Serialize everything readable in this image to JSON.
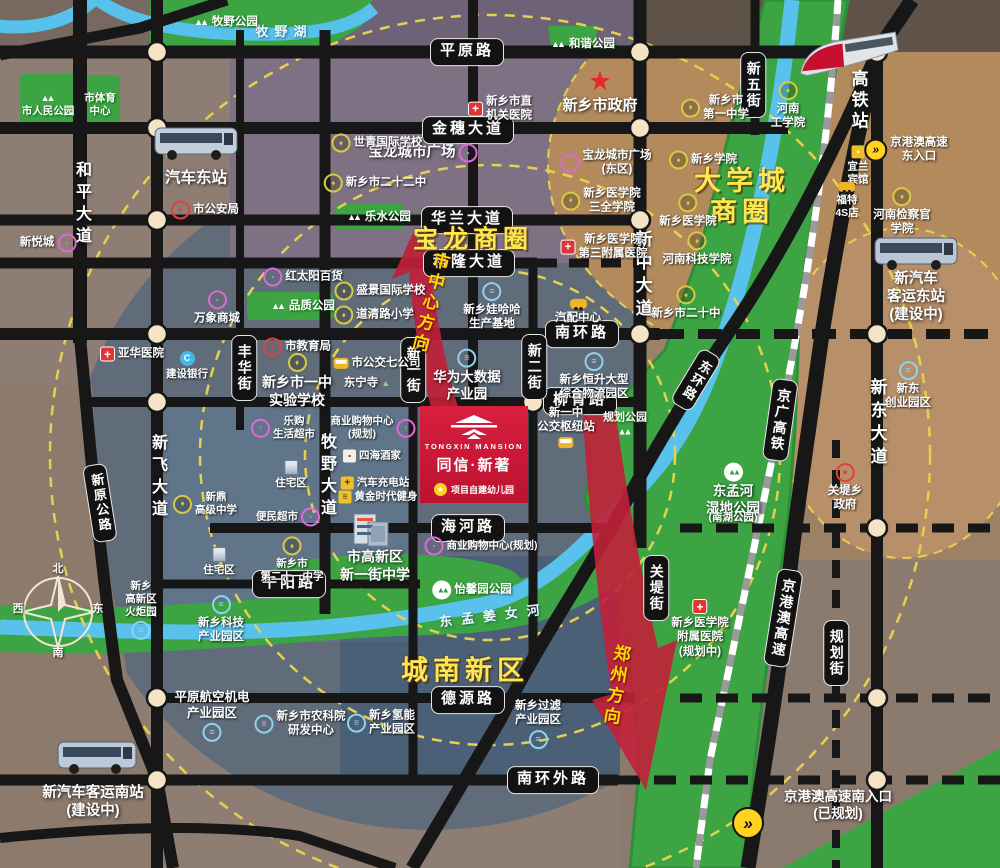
{
  "project": {
    "name_en": "TONGXIN MANSION",
    "name_cn": "同信·新著",
    "note": "项目自建幼儿园"
  },
  "colors": {
    "accent_red": "#c81734",
    "area_yellow": "#ffe54f",
    "green": "#3ca443",
    "river_blue": "#58c2ec",
    "road_black": "#171717",
    "dot_cream": "#f4e4c5",
    "dash_yellow": "#e6d14f"
  },
  "labels": [
    {
      "id": "road-pingyuanlu",
      "t": "平原路",
      "x": 467,
      "y": 52,
      "c": "pillh"
    },
    {
      "id": "road-jinsui-ave",
      "t": "金穗大道",
      "x": 468,
      "y": 130,
      "c": "pillh"
    },
    {
      "id": "road-hualan-ave",
      "t": "华兰大道",
      "x": 467,
      "y": 220,
      "c": "pillh"
    },
    {
      "id": "road-kelong-ave",
      "t": "科隆大道",
      "x": 469,
      "y": 263,
      "c": "pillh"
    },
    {
      "id": "road-nanhuanlu",
      "t": "南环路",
      "x": 582,
      "y": 334,
      "c": "pillh"
    },
    {
      "id": "road-liuqinglu",
      "t": "柳青路",
      "x": 580,
      "y": 401,
      "c": "pillh"
    },
    {
      "id": "road-haihelu",
      "t": "海河路",
      "x": 468,
      "y": 528,
      "c": "pillh"
    },
    {
      "id": "road-wuyanglu",
      "t": "午阳路",
      "x": 289,
      "y": 584,
      "c": "pillh"
    },
    {
      "id": "road-deyuanlu",
      "t": "德源路",
      "x": 468,
      "y": 700,
      "c": "pillh"
    },
    {
      "id": "road-nanhuanwailu",
      "t": "南环外路",
      "x": 553,
      "y": 780,
      "c": "pillh"
    },
    {
      "id": "road-fenghua-st",
      "t": "丰华街",
      "x": 244,
      "y": 368,
      "c": "pillv"
    },
    {
      "id": "road-xinyi-st",
      "t": "新一街",
      "x": 413,
      "y": 370,
      "c": "pillv"
    },
    {
      "id": "road-xiner-st",
      "t": "新二街",
      "x": 534,
      "y": 367,
      "c": "pillv"
    },
    {
      "id": "road-xinwu-st",
      "t": "新五街",
      "x": 753,
      "y": 85,
      "c": "pillv"
    },
    {
      "id": "road-guandi-st",
      "t": "关堤街",
      "x": 656,
      "y": 588,
      "c": "pillv"
    },
    {
      "id": "road-guihua-st",
      "t": "规划街",
      "x": 836,
      "y": 653,
      "c": "pillv"
    },
    {
      "id": "rail-jingguang-hsr",
      "t": "京广高铁",
      "x": 780,
      "y": 420,
      "c": "pillv",
      "r": 8
    },
    {
      "id": "road-jinggangao-expwy",
      "t": "京港澳高速",
      "x": 783,
      "y": 618,
      "c": "pillv",
      "r": 9
    },
    {
      "id": "road-donghuanlu",
      "t": "东环路",
      "x": 696,
      "y": 380,
      "c": "pillv",
      "r": 31,
      "fs": 13
    },
    {
      "id": "road-xinyuan-hwy",
      "t": "新原公路",
      "x": 100,
      "y": 503,
      "c": "pillv",
      "r": -9,
      "fs": 13
    },
    {
      "id": "road-heping-ave",
      "t": "和平大道",
      "x": 81,
      "y": 205,
      "c": "onroad"
    },
    {
      "id": "road-xinfei-ave",
      "t": "新飞大道",
      "x": 157,
      "y": 478,
      "c": "onroad"
    },
    {
      "id": "road-muye-ave",
      "t": "牧野大道",
      "x": 326,
      "y": 477,
      "c": "onroad"
    },
    {
      "id": "road-xinzhong-ave",
      "t": "新中大道",
      "x": 642,
      "y": 276,
      "c": "onroad",
      "fs": 17
    },
    {
      "id": "road-xindong-ave",
      "t": "新东大道",
      "x": 877,
      "y": 424,
      "c": "onroad",
      "fs": 17
    },
    {
      "id": "station-gaotie",
      "t": "高铁站",
      "x": 858,
      "y": 101,
      "c": "station"
    },
    {
      "id": "area-baolong",
      "t": "宝龙商圈",
      "x": 473,
      "y": 240,
      "c": "area",
      "fs": 25
    },
    {
      "id": "area-daxuecheng",
      "t": "大学城\n商圈",
      "x": 742,
      "y": 197,
      "c": "area"
    },
    {
      "id": "area-chengnan",
      "t": "城南新区",
      "x": 465,
      "y": 671,
      "c": "area"
    },
    {
      "id": "dir-city-center",
      "t": "市中心方向",
      "x": 429,
      "y": 303,
      "c": "dir",
      "r": 14
    },
    {
      "id": "dir-zhengzhou",
      "t": "郑州方向",
      "x": 615,
      "y": 686,
      "c": "dir",
      "r": 9
    },
    {
      "id": "river-muye-lake",
      "t": "牧野湖",
      "x": 284,
      "y": 32,
      "c": "river",
      "ls": 6
    },
    {
      "id": "river-dongmengjiangnv",
      "t": "东孟姜女河",
      "x": 494,
      "y": 616,
      "c": "river",
      "r": -7
    },
    {
      "id": "park-muye",
      "t": "牧野公园",
      "x": 226,
      "y": 22,
      "c": "park",
      "ic": "tree"
    },
    {
      "id": "park-renmin",
      "t": "市人民公园",
      "x": 48,
      "y": 106,
      "c": "park",
      "ic": "tree",
      "ip": "top",
      "fs": 10.5
    },
    {
      "id": "park-tiyu-center",
      "t": "市体育\n中心",
      "x": 100,
      "y": 105,
      "c": "park",
      "fs": 10.5
    },
    {
      "id": "park-hexie",
      "t": "和谐公园",
      "x": 583,
      "y": 44,
      "c": "park",
      "ic": "tree"
    },
    {
      "id": "park-leshui",
      "t": "乐水公园",
      "x": 379,
      "y": 217,
      "c": "park",
      "ic": "tree"
    },
    {
      "id": "park-pinzhi",
      "t": "品质公园",
      "x": 303,
      "y": 306,
      "c": "park",
      "ic": "tree"
    },
    {
      "id": "park-guihua",
      "t": "规划公园",
      "x": 625,
      "y": 424,
      "c": "park",
      "ic": "tree",
      "ip": "bottom",
      "fs": 11,
      "ls": 0,
      "t2": ""
    },
    {
      "id": "park-dongmenghe",
      "t": "东孟河\n湿地公园",
      "x": 733,
      "y": 490,
      "c": "poibig",
      "ic": "treec",
      "ip": "top",
      "fs": 13.5
    },
    {
      "id": "park-dongmenghe-sub",
      "t": "(南湖公园)",
      "x": 733,
      "y": 518,
      "c": "poi",
      "fs": 10.5
    },
    {
      "id": "park-yixinyuan",
      "t": "怡馨园公园",
      "x": 472,
      "y": 590,
      "c": "park",
      "ic": "treec"
    },
    {
      "id": "poi-shizhengfu",
      "t": "新乡市政府",
      "x": 600,
      "y": 92,
      "c": "poibig",
      "ic": "star",
      "ip": "top"
    },
    {
      "id": "poi-jiguan-hospital",
      "t": "新乡市直\n机关医院",
      "x": 500,
      "y": 109,
      "c": "poi",
      "ic": "hosp"
    },
    {
      "id": "poi-baolong-plaza",
      "t": "宝龙城市广场",
      "x": 423,
      "y": 153,
      "c": "poibig",
      "ic": "shop",
      "ip": "right",
      "fs": 14.5
    },
    {
      "id": "poi-shiqing-school",
      "t": "世青国际学校",
      "x": 377,
      "y": 143,
      "c": "poi",
      "ic": "school"
    },
    {
      "id": "poi-no22-middle",
      "t": "新乡市二十二中",
      "x": 375,
      "y": 183,
      "c": "poi",
      "ic": "school"
    },
    {
      "id": "station-qiche-east",
      "t": "汽车东站",
      "x": 196,
      "y": 178,
      "c": "poibig",
      "fs": 15.5
    },
    {
      "id": "poi-gonganju",
      "t": "市公安局",
      "x": 205,
      "y": 210,
      "c": "poi",
      "ic": "gov"
    },
    {
      "id": "poi-xinyuecheng",
      "t": "新悦城",
      "x": 48,
      "y": 243,
      "c": "poi",
      "ic": "shop",
      "ip": "right"
    },
    {
      "id": "poi-hongtaiyang",
      "t": "红太阳百货",
      "x": 303,
      "y": 277,
      "c": "poi",
      "ic": "shop"
    },
    {
      "id": "poi-wanxiang-mall",
      "t": "万象商城",
      "x": 217,
      "y": 308,
      "c": "poi",
      "ic": "shop",
      "ip": "top"
    },
    {
      "id": "poi-yahua-hospital",
      "t": "亚华医院",
      "x": 132,
      "y": 354,
      "c": "poi",
      "ic": "hosp"
    },
    {
      "id": "poi-jianshe-bank",
      "t": "建设银行",
      "x": 187,
      "y": 366,
      "c": "poi",
      "ic": "bank",
      "ip": "top",
      "fs": 10.5
    },
    {
      "id": "poi-jiaoyuju",
      "t": "市教育局",
      "x": 297,
      "y": 347,
      "c": "poi",
      "ic": "gov"
    },
    {
      "id": "poi-yizhong-shiyan",
      "t": "新乡市一中\n实验学校",
      "x": 297,
      "y": 381,
      "c": "poibig",
      "ic": "school",
      "ip": "top",
      "fs": 14
    },
    {
      "id": "poi-shengjing-school",
      "t": "盛景国际学校",
      "x": 380,
      "y": 291,
      "c": "poi",
      "ic": "school"
    },
    {
      "id": "poi-daoqinglu-school",
      "t": "道清路小学",
      "x": 374,
      "y": 315,
      "c": "poi",
      "ic": "school"
    },
    {
      "id": "poi-bus7-company",
      "t": "市公交七公司",
      "x": 377,
      "y": 363,
      "c": "poi",
      "ic": "bus"
    },
    {
      "id": "poi-dongningsi",
      "t": "东宁寺",
      "x": 367,
      "y": 383,
      "c": "poi",
      "ic": "temple",
      "ip": "right"
    },
    {
      "id": "poi-wahaha",
      "t": "新乡娃哈哈\n生产基地",
      "x": 492,
      "y": 307,
      "c": "poi",
      "ic": "ind",
      "ip": "top"
    },
    {
      "id": "poi-qipei-center",
      "t": "汽配中心",
      "x": 578,
      "y": 312,
      "c": "poi",
      "ic": "car",
      "ip": "top"
    },
    {
      "id": "poi-huawei-bigdata",
      "t": "华为大数据\n产业园",
      "x": 467,
      "y": 376,
      "c": "poibig",
      "ic": "ind",
      "ip": "top",
      "fs": 13.5
    },
    {
      "id": "poi-hengsheng-logistics",
      "t": "新乡恒升大型\n综合物流园区",
      "x": 594,
      "y": 377,
      "c": "poi",
      "ic": "ind",
      "ip": "top"
    },
    {
      "id": "poi-xinyizhong-hub",
      "t": "新一中\n公交枢纽站",
      "x": 566,
      "y": 427,
      "c": "poi",
      "ic": "bus",
      "ip": "bottom"
    },
    {
      "id": "poi-baolong-east",
      "t": "宝龙城市广场\n(东区)",
      "x": 606,
      "y": 163,
      "c": "poi",
      "ic": "shop"
    },
    {
      "id": "poi-sanquan-college",
      "t": "新乡医学院\n三全学院",
      "x": 601,
      "y": 201,
      "c": "poi",
      "ic": "school"
    },
    {
      "id": "poi-no3-hospital",
      "t": "新乡医学院\n第三附属医院",
      "x": 604,
      "y": 247,
      "c": "poi",
      "ic": "hosp"
    },
    {
      "id": "poi-xinxiang-college",
      "t": "新乡学院",
      "x": 703,
      "y": 160,
      "c": "poi",
      "ic": "school"
    },
    {
      "id": "poi-yixueyuan",
      "t": "新乡医学院",
      "x": 688,
      "y": 211,
      "c": "poi",
      "ic": "school",
      "ip": "top"
    },
    {
      "id": "poi-keji-college",
      "t": "河南科技学院",
      "x": 697,
      "y": 249,
      "c": "poi",
      "ic": "school",
      "ip": "top"
    },
    {
      "id": "poi-no20-middle",
      "t": "新乡市二十中",
      "x": 686,
      "y": 303,
      "c": "poi",
      "ic": "school",
      "ip": "top"
    },
    {
      "id": "poi-no1-middle",
      "t": "新乡市\n第一中学",
      "x": 715,
      "y": 108,
      "c": "poi",
      "ic": "school"
    },
    {
      "id": "poi-henan-gongxueyuan",
      "t": "河南\n工学院",
      "x": 788,
      "y": 106,
      "c": "poi",
      "ic": "school",
      "ip": "top"
    },
    {
      "id": "poi-jianchaguan-college",
      "t": "河南检察官\n学院",
      "x": 902,
      "y": 212,
      "c": "poi",
      "ic": "school",
      "ip": "top"
    },
    {
      "id": "poi-yilan-hotel",
      "t": "宜兰\n宾馆",
      "x": 858,
      "y": 166,
      "c": "poi",
      "ic": "hotel",
      "ip": "top",
      "fs": 10.5
    },
    {
      "id": "poi-ford-4s",
      "t": "福特\n4S店",
      "x": 847,
      "y": 201,
      "c": "poi",
      "ic": "car",
      "ip": "top",
      "fs": 10.5
    },
    {
      "id": "poi-expwy-east-entrance",
      "t": "京港澳高速\n东入口",
      "x": 906,
      "y": 150,
      "c": "poi",
      "ic": "hw"
    },
    {
      "id": "station-keyun-east",
      "t": "新汽车\n客运东站\n(建设中)",
      "x": 916,
      "y": 297,
      "c": "poibig",
      "fs": 14.5
    },
    {
      "id": "poi-xindong-startup-park",
      "t": "新东\n创业园区",
      "x": 908,
      "y": 386,
      "c": "poi",
      "ic": "ind",
      "ip": "top"
    },
    {
      "id": "poi-guandi-gov",
      "t": "关堤乡\n政府",
      "x": 845,
      "y": 488,
      "c": "poi",
      "ic": "gov",
      "ip": "top"
    },
    {
      "id": "poi-fushu-hospital",
      "t": "新乡医学院\n附属医院\n(规划中)",
      "x": 700,
      "y": 629,
      "c": "poi",
      "ic": "hosp",
      "ip": "top"
    },
    {
      "id": "poi-shangye-center-plan",
      "t": "商业购物中心\n(规划)",
      "x": 373,
      "y": 428,
      "c": "poi",
      "ic": "shop",
      "ip": "right",
      "fs": 10.5
    },
    {
      "id": "poi-sihai-restaurant",
      "t": "四海酒家",
      "x": 372,
      "y": 456,
      "c": "poi",
      "ic": "rest",
      "fs": 10.5
    },
    {
      "id": "poi-charging-station",
      "t": "汽车充电站",
      "x": 375,
      "y": 483,
      "c": "poi",
      "ic": "charge",
      "fs": 10.5
    },
    {
      "id": "poi-golden-gym",
      "t": "黄金时代健身",
      "x": 378,
      "y": 497,
      "c": "poi",
      "ic": "gym",
      "fs": 10.5
    },
    {
      "id": "poi-bianmin-market",
      "t": "便民超市",
      "x": 288,
      "y": 517,
      "c": "poi",
      "ic": "shop",
      "ip": "right",
      "fs": 10.5
    },
    {
      "id": "poi-legou-market",
      "t": "乐购\n生活超市",
      "x": 283,
      "y": 428,
      "c": "poi",
      "ic": "shop",
      "fs": 10.5
    },
    {
      "id": "poi-zhuzhai-a",
      "t": "住宅区",
      "x": 291,
      "y": 475,
      "c": "poi",
      "ic": "bld",
      "ip": "top",
      "fs": 10.5
    },
    {
      "id": "poi-zhuzhai-b",
      "t": "住宅区",
      "x": 219,
      "y": 562,
      "c": "poi",
      "ic": "bld",
      "ip": "top",
      "fs": 10.5
    },
    {
      "id": "poi-xinding-school",
      "t": "新鼎\n高级中学",
      "x": 205,
      "y": 504,
      "c": "poi",
      "ic": "school",
      "fs": 10.5
    },
    {
      "id": "poi-no21-middle",
      "t": "新乡市\n第二十一中学",
      "x": 292,
      "y": 560,
      "c": "poi",
      "ic": "school",
      "ip": "top",
      "fs": 10.5
    },
    {
      "id": "poi-shangye-haihe",
      "t": "商业购物中心(规划)",
      "x": 481,
      "y": 546,
      "c": "poi",
      "ic": "shop",
      "fs": 10.5
    },
    {
      "id": "poi-xinyijie-middle",
      "t": "市高新区\n新一街中学",
      "x": 375,
      "y": 566,
      "c": "poibig",
      "fs": 14
    },
    {
      "id": "poi-keji-park",
      "t": "新乡科技\n产业园区",
      "x": 221,
      "y": 620,
      "c": "poi",
      "ic": "ind",
      "ip": "top"
    },
    {
      "id": "poi-huoju-park",
      "t": "新乡\n高新区\n火炬园",
      "x": 141,
      "y": 610,
      "c": "poi",
      "ic": "ind",
      "ip": "bottom",
      "fs": 10.5
    },
    {
      "id": "poi-pingyuan-aero",
      "t": "平原航空机电\n产业园区",
      "x": 212,
      "y": 716,
      "c": "poi",
      "ic": "ind",
      "ip": "bottom",
      "fs": 12.5
    },
    {
      "id": "poi-nongkeyuan",
      "t": "新乡市农科院\n研发中心",
      "x": 300,
      "y": 724,
      "c": "poi",
      "ic": "ind"
    },
    {
      "id": "poi-qingneng-park",
      "t": "新乡氢能\n产业园区",
      "x": 381,
      "y": 723,
      "c": "poi",
      "ic": "ind"
    },
    {
      "id": "poi-guolv-park",
      "t": "新乡过滤\n产业园区",
      "x": 538,
      "y": 724,
      "c": "poi",
      "ic": "ind",
      "ip": "bottom"
    },
    {
      "id": "station-keyun-south",
      "t": "新汽车客运南站\n(建设中)",
      "x": 93,
      "y": 802,
      "c": "poibig",
      "fs": 14.5
    },
    {
      "id": "poi-expwy-south-entrance",
      "t": "京港澳高速南入口\n(已规划)",
      "x": 838,
      "y": 806,
      "c": "poibig",
      "fs": 13.5
    },
    {
      "id": "icon-expwy-south",
      "t": "",
      "x": 748,
      "y": 823,
      "c": "poi",
      "ic": "hwbig"
    },
    {
      "id": "compass-north",
      "t": "北",
      "x": 58,
      "y": 570,
      "c": "poi",
      "fs": 11
    },
    {
      "id": "compass-east",
      "t": "东",
      "x": 98,
      "y": 610,
      "c": "poi",
      "fs": 11
    },
    {
      "id": "compass-south",
      "t": "南",
      "x": 58,
      "y": 654,
      "c": "poi",
      "fs": 11
    },
    {
      "id": "compass-west",
      "t": "西",
      "x": 18,
      "y": 610,
      "c": "poi",
      "fs": 11
    }
  ]
}
